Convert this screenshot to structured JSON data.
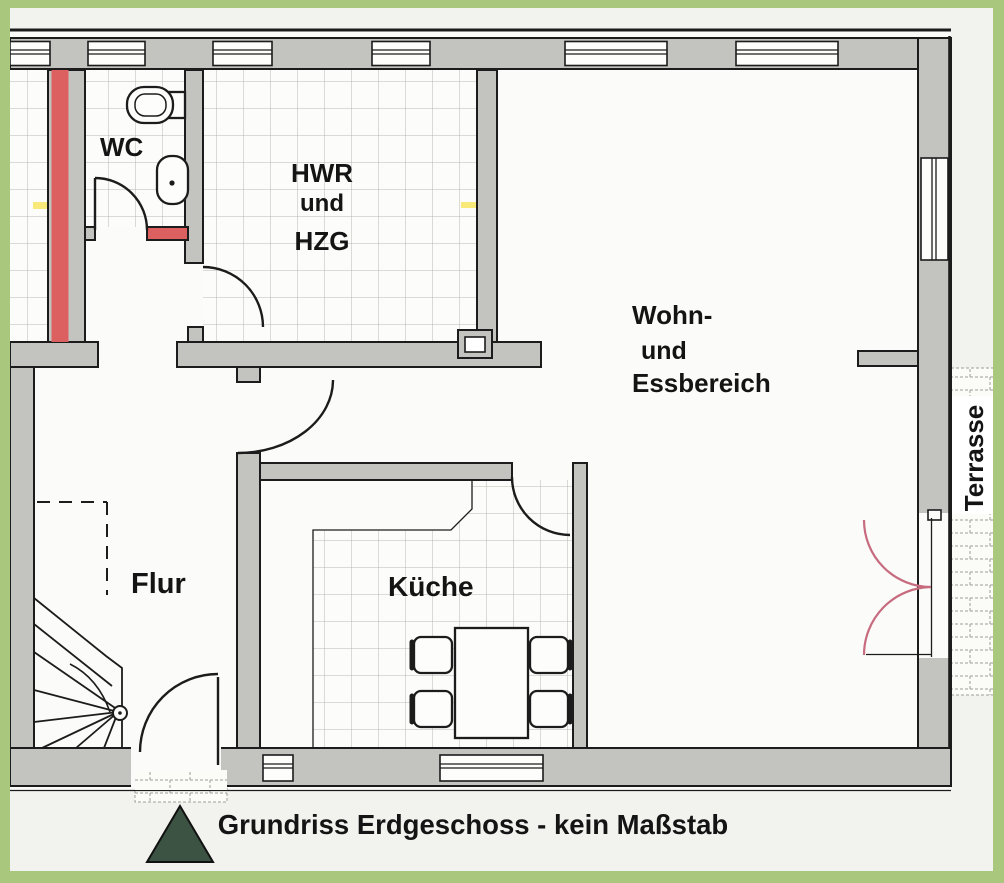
{
  "plan": {
    "title": "Grundriss Erdgeschoss - kein Maßstab",
    "rooms": {
      "wc": {
        "label": "WC"
      },
      "hwr": {
        "line1": "HWR",
        "line2": "und",
        "line3": "HZG"
      },
      "wohnen": {
        "line1": "Wohn-",
        "line2": "und",
        "line3": "Essbereich"
      },
      "flur": {
        "label": "Flur"
      },
      "kueche": {
        "label": "Küche"
      },
      "terrasse": {
        "label": "Terrasse"
      }
    },
    "colors": {
      "frame_green": "#a9c87e",
      "wall_gray": "#c3c3bf",
      "marked_wall_red": "#dc6060",
      "terrace_door_pink": "#c76b7f",
      "north_marker_green": "#3c5243",
      "highlight_yellow": "#f7e457"
    }
  }
}
